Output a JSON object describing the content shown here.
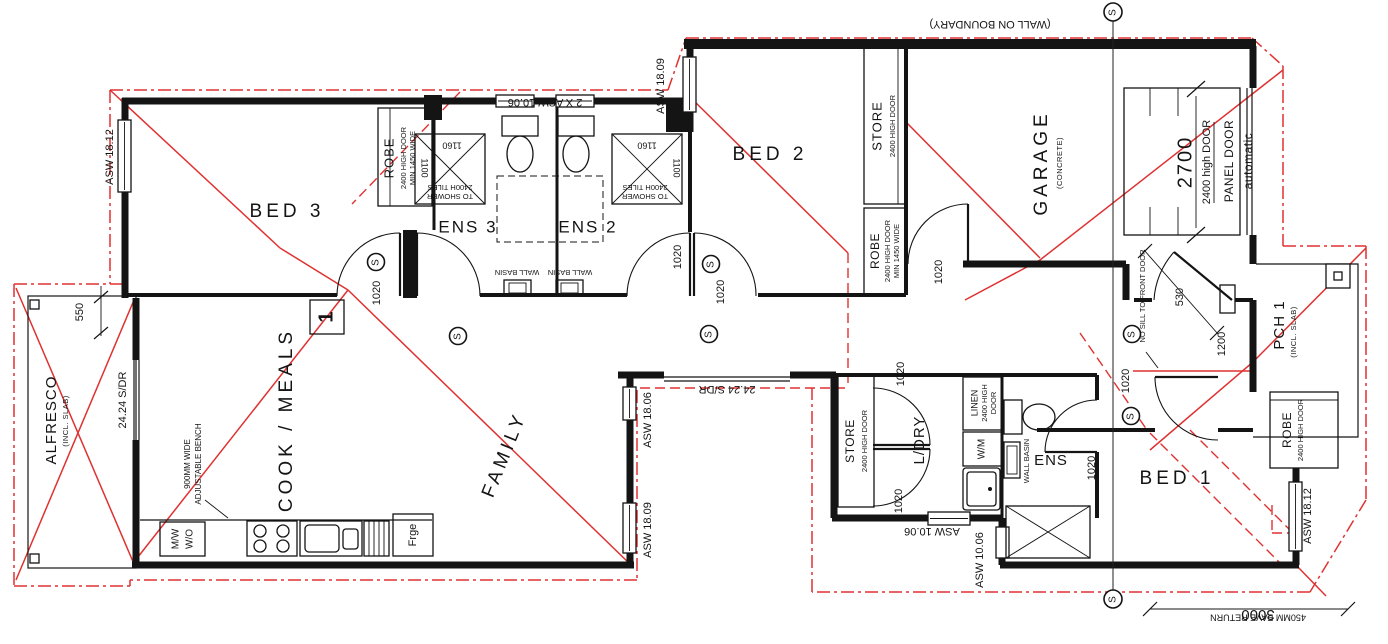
{
  "colors": {
    "roof_line": "#e03131",
    "wall": "#141414",
    "paper": "#ffffff"
  },
  "symbols": {
    "s": "S"
  },
  "rooms": {
    "bed3": "BED 3",
    "ens3": "ENS 3",
    "ens2": "ENS 2",
    "bed2": "BED 2",
    "garage": "GARAGE",
    "garage_sub": "(CONCRETE)",
    "alfresco": "ALFRESCO",
    "alfresco_sub": "(INCL. SLAB)",
    "cook_meals": "COOK / MEALS",
    "family": "FAMILY",
    "ldry": "L/DRY",
    "ens": "ENS",
    "bed1": "BED 1",
    "pch1": "PCH 1",
    "pch1_sub": "(INCL. SLAB)"
  },
  "storage": {
    "robe": "ROBE",
    "store": "STORE",
    "door_2400": "2400 HIGH DOOR",
    "min_1450": "MIN 1450 WIDE",
    "linen_1": "LINEN",
    "linen_2": "2400 HIGH",
    "linen_3": "DOOR"
  },
  "fixtures": {
    "wm": "W/M",
    "wall_basin": "WALL BASIN",
    "mw": "M/W",
    "wo": "W/O",
    "fridge": "Frge",
    "bench_1": "900MM WIDE",
    "bench_2": "ADJUSTABLE BENCH",
    "shower_tiles_1": "2400H TILES",
    "shower_tiles_2": "TO SHOWER"
  },
  "garage_door": {
    "panel": "PANEL DOOR",
    "mode": "automatic",
    "width": "2700",
    "height": "2400 high DOOR",
    "no_sill": "NO SILL TO FRONT DOOR"
  },
  "windows": {
    "asw1812": "ASW 18.12",
    "asw2x1006": "2 X ASW 10.06",
    "asw1809": "ASW 18.09",
    "asw1806": "ASW 18.06",
    "asw1006": "ASW 10.06",
    "sdr2424": "24.24 S/DR"
  },
  "dims": {
    "d550": "550",
    "d530": "530",
    "d1200": "1200",
    "d1020": "1020",
    "d1160": "1160",
    "d1100": "1100",
    "d3000": "3000",
    "eave_return": "450MM EAVE RETURN",
    "marker_1": "1"
  },
  "notes": {
    "boundary": "(WALL ON BOUNDARY)"
  }
}
